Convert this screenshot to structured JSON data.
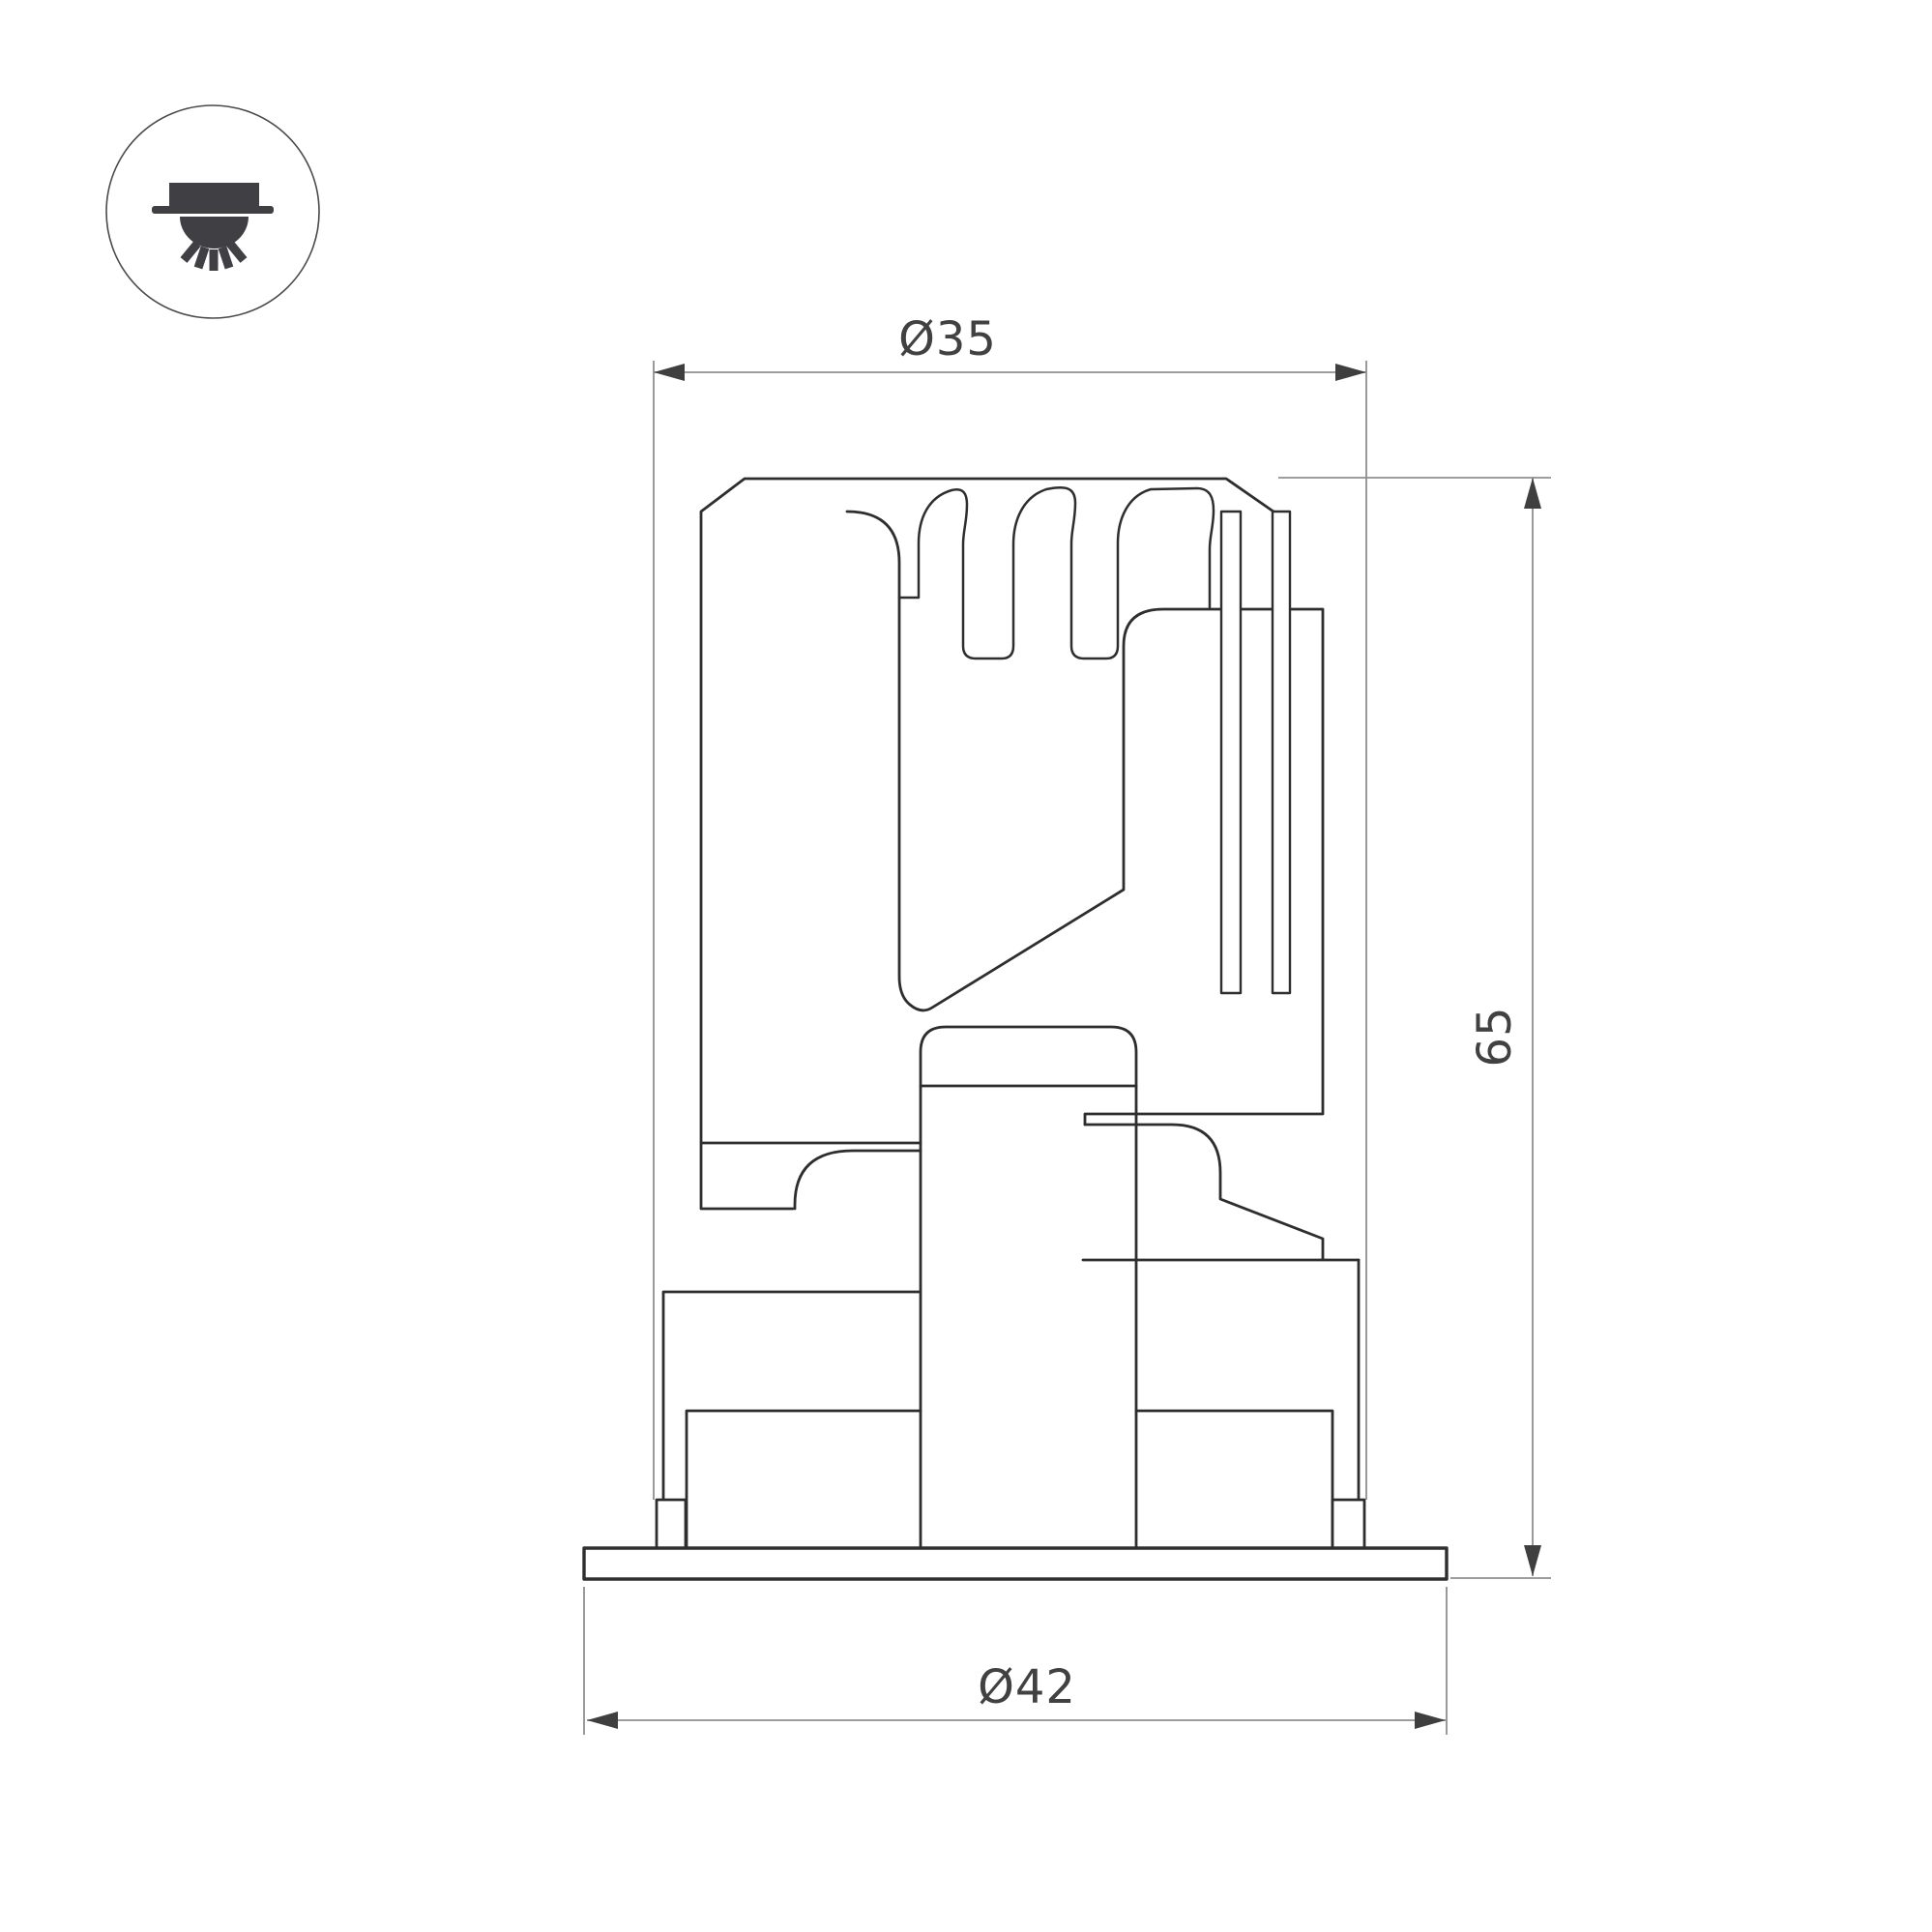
{
  "title": "Recessed downlight technical drawing",
  "icon": {
    "name": "recessed-downlight-ceiling-icon"
  },
  "dimensions": {
    "top_diameter": "Ø35",
    "height": "65",
    "bottom_diameter": "Ø42"
  },
  "colors": {
    "outline": "#2e2e2e",
    "icon_glyph": "#3f3f44",
    "icon_circle": "#4a4a4a",
    "dimension_lines": "#8f8f8f",
    "arrows": "#3f3f3f",
    "text": "#414141",
    "background": "#ffffff"
  }
}
